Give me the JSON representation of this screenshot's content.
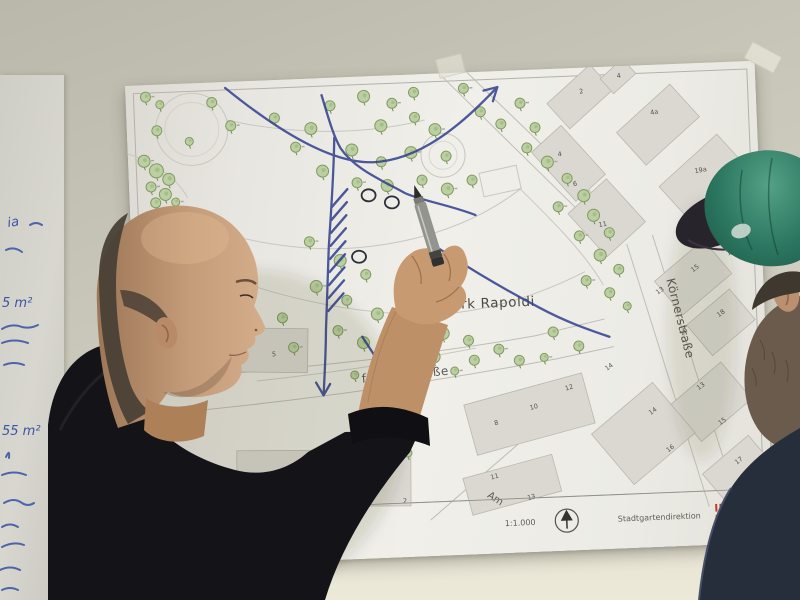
{
  "colors": {
    "marker_blue": "#2e3f8e",
    "tree_fill": "#bccfa2",
    "tree_stroke": "#7e9b60",
    "logo_red": "#c63528",
    "cap_green": "#2e7a63"
  },
  "flipchart": {
    "lines": [
      "ia",
      "5 m²",
      "55 m²"
    ]
  },
  "poster": {
    "title": "Stadtpark Rapoldi",
    "streets": [
      {
        "label": "freggerstraße"
      },
      {
        "label": "Körnerstraße"
      },
      {
        "label": "Am"
      }
    ],
    "legend": {
      "cadastre": "kataster / Grünflächenkataster",
      "scale": "1:1.000",
      "agency": "Stadtgartendirektion"
    },
    "logo_lines": [
      "IN",
      "B"
    ],
    "building_numbers": [
      {
        "label": "2",
        "x": 454,
        "y": 26,
        "rot": -8
      },
      {
        "label": "4",
        "x": 492,
        "y": 12,
        "rot": -8
      },
      {
        "label": "4a",
        "x": 524,
        "y": 50,
        "rot": -8
      },
      {
        "label": "4",
        "x": 430,
        "y": 88,
        "rot": -8
      },
      {
        "label": "6",
        "x": 444,
        "y": 118,
        "rot": -8
      },
      {
        "label": "11",
        "x": 468,
        "y": 160,
        "rot": -8
      },
      {
        "label": "19a",
        "x": 566,
        "y": 110,
        "rot": -8
      },
      {
        "label": "17",
        "x": 596,
        "y": 194,
        "rot": -34
      },
      {
        "label": "15",
        "x": 560,
        "y": 209,
        "rot": -34
      },
      {
        "label": "13",
        "x": 524,
        "y": 230,
        "rot": -34
      },
      {
        "label": "18",
        "x": 584,
        "y": 255,
        "rot": -34
      },
      {
        "label": "16",
        "x": 546,
        "y": 272,
        "rot": -34
      },
      {
        "label": "13",
        "x": 561,
        "y": 327,
        "rot": -34
      },
      {
        "label": "15",
        "x": 581,
        "y": 363,
        "rot": -34
      },
      {
        "label": "17",
        "x": 596,
        "y": 403,
        "rot": -34
      },
      {
        "label": "14",
        "x": 470,
        "y": 304,
        "rot": -34
      },
      {
        "label": "12",
        "x": 428,
        "y": 322,
        "rot": -13
      },
      {
        "label": "10",
        "x": 392,
        "y": 340,
        "rot": -13
      },
      {
        "label": "8",
        "x": 356,
        "y": 354,
        "rot": -13
      },
      {
        "label": "14",
        "x": 512,
        "y": 350,
        "rot": -34
      },
      {
        "label": "16",
        "x": 528,
        "y": 388,
        "rot": -34
      },
      {
        "label": "11",
        "x": 350,
        "y": 408,
        "rot": -13
      },
      {
        "label": "13",
        "x": 386,
        "y": 430,
        "rot": -13
      },
      {
        "label": "5",
        "x": 136,
        "y": 276,
        "rot": 0
      },
      {
        "label": "1",
        "x": 200,
        "y": 420,
        "rot": 0
      },
      {
        "label": "2",
        "x": 261,
        "y": 428,
        "rot": 0
      }
    ],
    "trees": [
      [
        20,
        12,
        5
      ],
      [
        34,
        20,
        4
      ],
      [
        86,
        20,
        5
      ],
      [
        104,
        44,
        5
      ],
      [
        30,
        46,
        5
      ],
      [
        62,
        58,
        4
      ],
      [
        16,
        76,
        6
      ],
      [
        28,
        86,
        7
      ],
      [
        40,
        95,
        6
      ],
      [
        22,
        102,
        5
      ],
      [
        36,
        110,
        6
      ],
      [
        26,
        118,
        5
      ],
      [
        46,
        118,
        4
      ],
      [
        148,
        38,
        5
      ],
      [
        184,
        50,
        6
      ],
      [
        168,
        68,
        5
      ],
      [
        204,
        28,
        5
      ],
      [
        238,
        20,
        6
      ],
      [
        266,
        28,
        5
      ],
      [
        254,
        50,
        6
      ],
      [
        288,
        43,
        5
      ],
      [
        308,
        56,
        6
      ],
      [
        224,
        73,
        6
      ],
      [
        253,
        86,
        5
      ],
      [
        283,
        78,
        6
      ],
      [
        318,
        83,
        5
      ],
      [
        194,
        93,
        6
      ],
      [
        228,
        106,
        5
      ],
      [
        258,
        110,
        6
      ],
      [
        293,
        106,
        5
      ],
      [
        318,
        116,
        6
      ],
      [
        343,
        108,
        5
      ],
      [
        288,
        18,
        5
      ],
      [
        338,
        16,
        5
      ],
      [
        354,
        40,
        5
      ],
      [
        374,
        53,
        5
      ],
      [
        394,
        33,
        5
      ],
      [
        408,
        58,
        5
      ],
      [
        399,
        78,
        5
      ],
      [
        419,
        93,
        6
      ],
      [
        438,
        110,
        5
      ],
      [
        454,
        128,
        6
      ],
      [
        428,
        138,
        5
      ],
      [
        463,
        148,
        6
      ],
      [
        478,
        166,
        5
      ],
      [
        448,
        168,
        5
      ],
      [
        468,
        188,
        6
      ],
      [
        486,
        203,
        5
      ],
      [
        453,
        213,
        5
      ],
      [
        476,
        226,
        5
      ],
      [
        493,
        240,
        4
      ],
      [
        178,
        163,
        5
      ],
      [
        208,
        183,
        6
      ],
      [
        233,
        198,
        5
      ],
      [
        183,
        208,
        6
      ],
      [
        213,
        223,
        5
      ],
      [
        243,
        238,
        6
      ],
      [
        203,
        253,
        5
      ],
      [
        228,
        266,
        6
      ],
      [
        263,
        256,
        5
      ],
      [
        288,
        248,
        5
      ],
      [
        308,
        260,
        6
      ],
      [
        333,
        268,
        5
      ],
      [
        253,
        283,
        5
      ],
      [
        298,
        283,
        6
      ],
      [
        338,
        288,
        5
      ],
      [
        363,
        278,
        5
      ],
      [
        383,
        290,
        5
      ],
      [
        148,
        238,
        5
      ],
      [
        158,
        268,
        5
      ],
      [
        418,
        263,
        5
      ],
      [
        443,
        278,
        5
      ],
      [
        408,
        288,
        4
      ],
      [
        218,
        298,
        4
      ],
      [
        258,
        300,
        4
      ],
      [
        318,
        298,
        4
      ],
      [
        268,
        378,
        4
      ]
    ]
  }
}
